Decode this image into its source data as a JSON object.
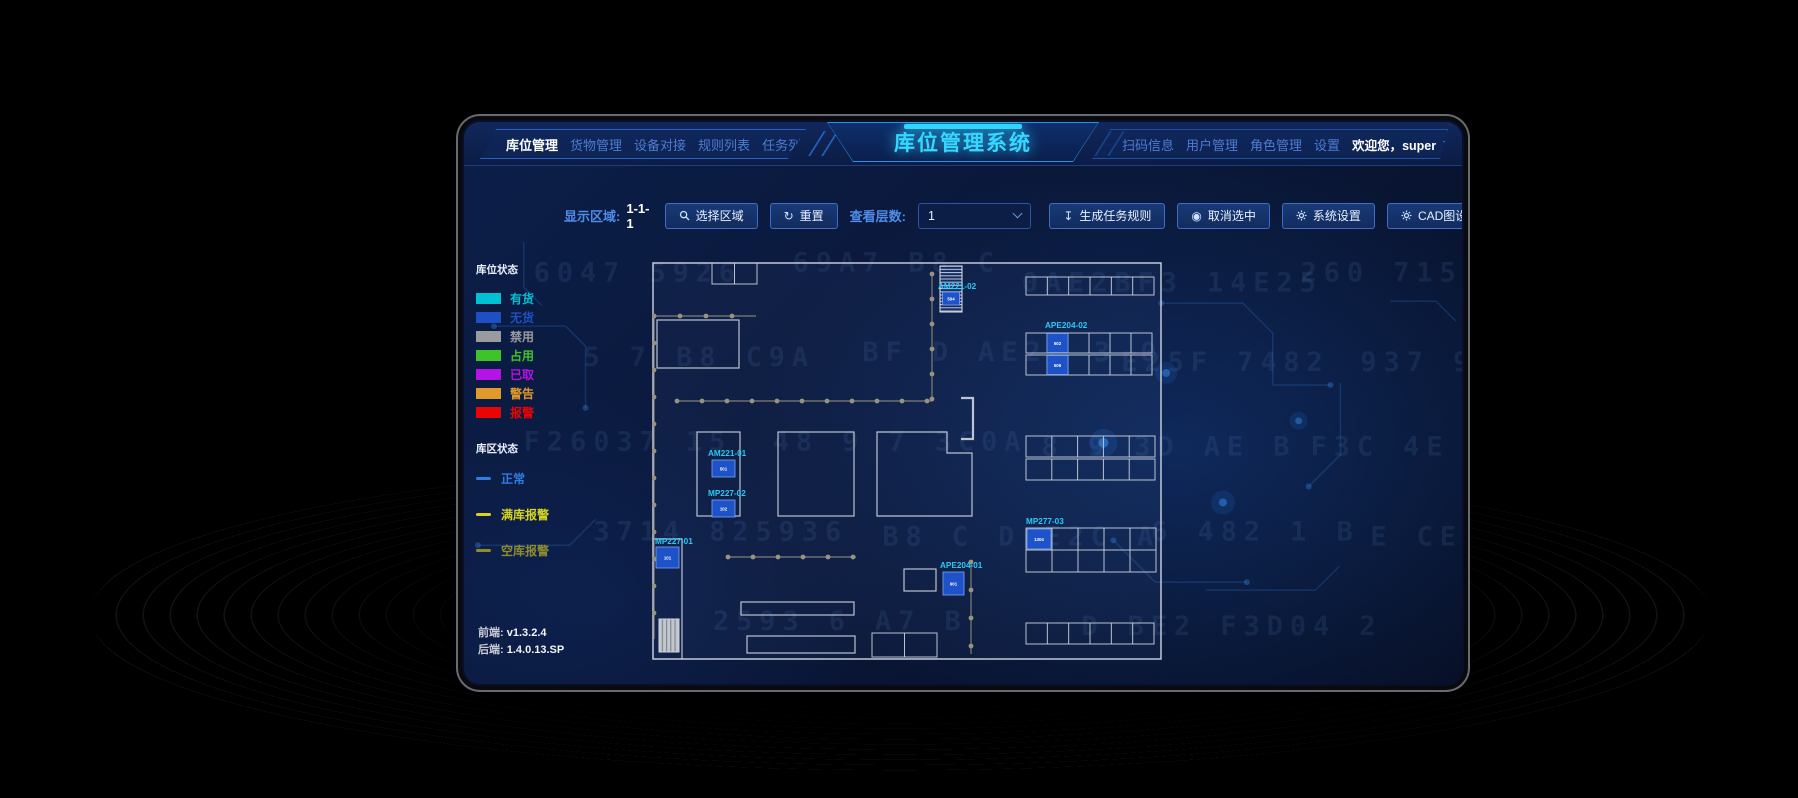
{
  "app": {
    "title": "库位管理系统",
    "nav_left": [
      {
        "label": "库位管理",
        "active": true
      },
      {
        "label": "货物管理",
        "active": false
      },
      {
        "label": "设备对接",
        "active": false
      },
      {
        "label": "规则列表",
        "active": false
      },
      {
        "label": "任务列表",
        "active": false
      }
    ],
    "nav_right": [
      {
        "label": "扫码信息"
      },
      {
        "label": "用户管理"
      },
      {
        "label": "角色管理"
      },
      {
        "label": "设置"
      }
    ],
    "welcome_text": "欢迎您，super"
  },
  "toolbar": {
    "display_area_label": "显示区域:",
    "display_area_value": "1-1-1",
    "select_area_button": "选择区域",
    "reset_button": "重置",
    "floor_label": "查看层数:",
    "floor_selected": "1",
    "generate_rule_button": "生成任务规则",
    "cancel_selection_button": "取消选中",
    "system_settings_button": "系统设置",
    "cad_settings_button": "CAD图设置",
    "upload_button": "上传文件",
    "refresh_icon_glyph": "↻",
    "download_icon_glyph": "↧",
    "upload_icon_glyph": "↥",
    "cancel_icon_glyph": "◉"
  },
  "legend": {
    "slot_status_title": "库位状态",
    "slot_statuses": [
      {
        "label": "有货",
        "color": "#00c0d4"
      },
      {
        "label": "无货",
        "color": "#1e4fc4"
      },
      {
        "label": "禁用",
        "color": "#9a9ba1"
      },
      {
        "label": "占用",
        "color": "#3ec428"
      },
      {
        "label": "已取",
        "color": "#b512e8"
      },
      {
        "label": "警告",
        "color": "#e09a2c"
      },
      {
        "label": "报警",
        "color": "#ea0504"
      }
    ],
    "zone_status_title": "库区状态",
    "zone_statuses": [
      {
        "label": "正常",
        "color": "#2e7de4"
      },
      {
        "label": "满库报警",
        "color": "#d6d41e"
      },
      {
        "label": "空库报警",
        "color": "#8e8c2f"
      }
    ]
  },
  "versions": {
    "frontend_label": "前端:",
    "frontend_value": "v1.3.2.4",
    "backend_label": "后端:",
    "backend_value": "1.4.0.13.SP"
  },
  "floorplan": {
    "stations": [
      {
        "id": "AM221-02",
        "cell": "504"
      },
      {
        "id": "APE204-02",
        "cell_top": "502",
        "cell_bottom": "506"
      },
      {
        "id": "AM221-01",
        "cell": "501"
      },
      {
        "id": "MP227-02",
        "cell": "102"
      },
      {
        "id": "MP227-01",
        "cell": "101"
      },
      {
        "id": "APE204-01",
        "cell": "901"
      },
      {
        "id": "MP277-03",
        "cell": "1304"
      }
    ]
  },
  "background_code_fragments": [
    "6047 5926",
    "69A7 B8 C",
    "0AE2BF3 14E25",
    "260 715936 47",
    "5 7 B8 C9A",
    "BF D AE2C 3 0",
    "E25F 7482",
    "937 9A7 B8 C",
    "F26037 15",
    "48 9 7 3C0A",
    "8 9 3D AE B",
    "F3C 4E 5 38",
    "3714 825936",
    "B8 C D E2C A",
    "6 482 1 B",
    "E CE 15 37",
    "2593 6 A7 B",
    "D BE2 F3D04 2"
  ]
}
